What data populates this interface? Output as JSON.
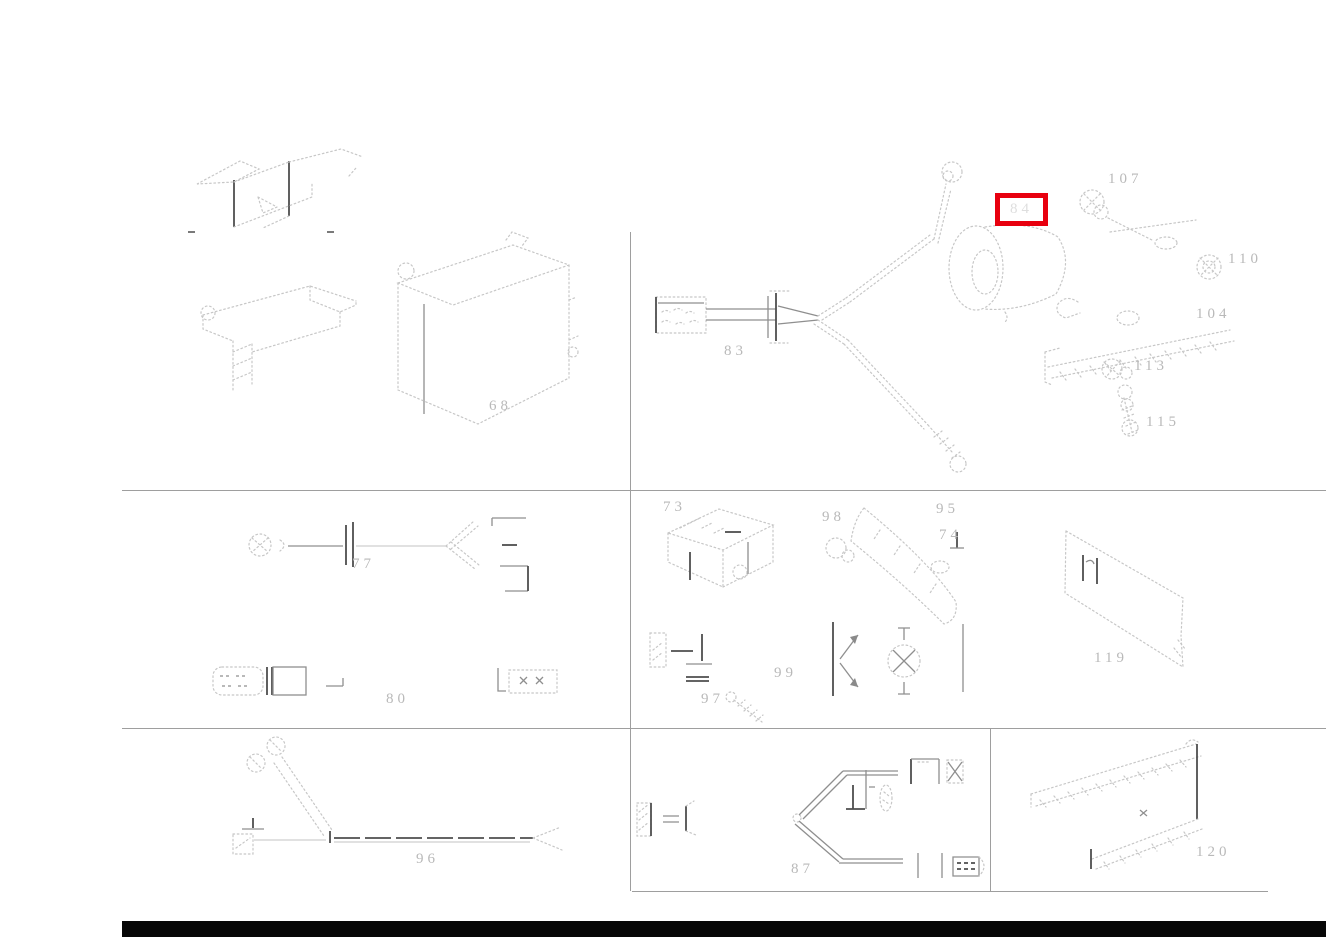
{
  "page": {
    "type": "parts-diagram",
    "background": "#ffffff",
    "divider_color": "#9e9e9e",
    "sketch_color": "#c7c7c7",
    "label_color": "#b9b9b9",
    "footer_bar_color": "#070707",
    "highlight_box_color": "#e8000f"
  },
  "parts": {
    "top_left": {
      "control_unit": "68"
    },
    "top_right": {
      "harness": "83",
      "highlighted": "84",
      "screw_assembly": "107",
      "lock_nut": "110",
      "bracket": "104",
      "washers": "113",
      "screw": "115"
    },
    "mid_left": {
      "antenna_cable": "77",
      "sleeve": "80"
    },
    "mid_center": {
      "relay_block": "73",
      "arm": "98",
      "clip": "95",
      "grommet": "74",
      "cable_clip": "99",
      "small_screw": "97"
    },
    "mid_right": {
      "cover_panel": "119"
    },
    "bottom_left": {
      "harness": "96"
    },
    "bottom_center": {
      "fork_harness": "87"
    },
    "bottom_right": {
      "sill_strip": "120"
    }
  }
}
